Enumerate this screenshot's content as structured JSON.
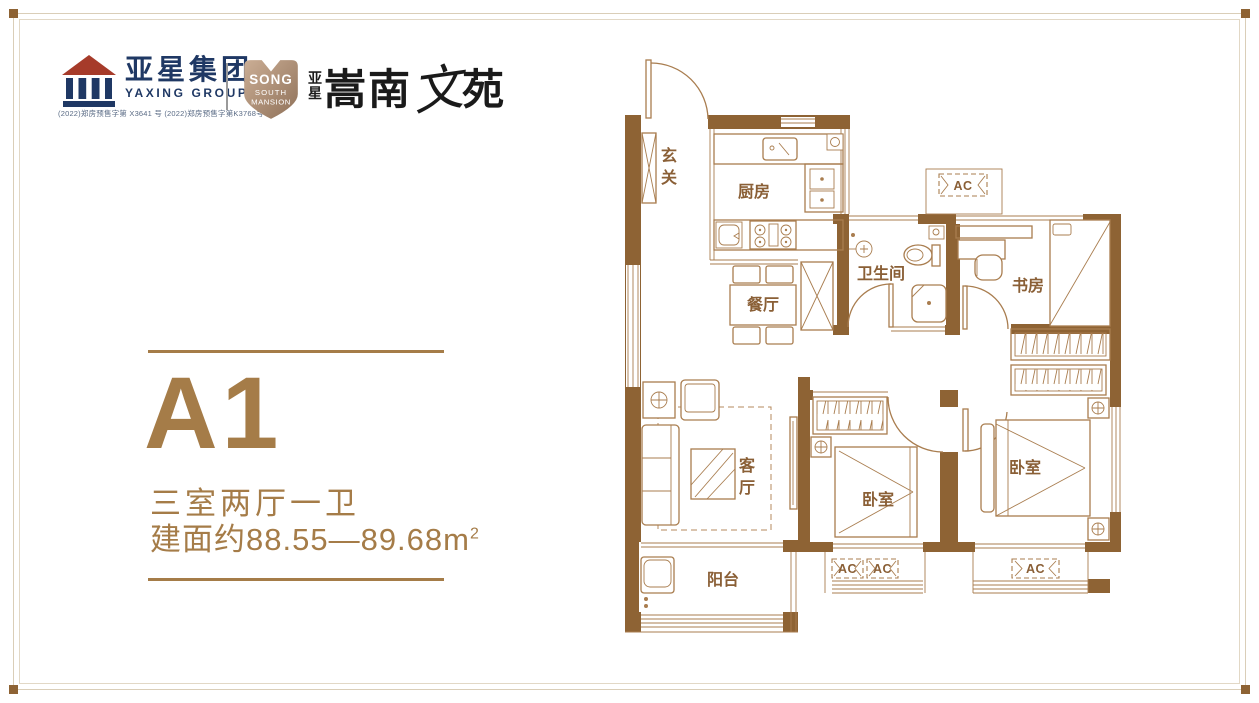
{
  "header": {
    "logo": {
      "name": "亚星集团",
      "reg_mark": "®",
      "sub": "YAXING GROUP",
      "permits": "(2022)郑房预售字第 X3641 号 (2022)郑房预售字第K3768号"
    },
    "badge": {
      "line1": "SONG",
      "line2": "SOUTH",
      "line3": "MANSION"
    },
    "brand": {
      "prefix_top": "亚",
      "prefix_bottom": "星",
      "name_pre": "嵩南",
      "name_stylized": "文",
      "name_post": "苑"
    }
  },
  "info": {
    "unit_code": "A1",
    "layout_desc": "三室两厅一卫",
    "area_prefix": "建面约",
    "area_value": "88.55—89.68",
    "area_unit": "m",
    "area_sup": "2"
  },
  "floorplan": {
    "colors": {
      "wall": "#8E6334",
      "line": "#A97D4F",
      "label": "#8A5F36",
      "accent": "#A57C48"
    },
    "labels": {
      "foyer": [
        "玄",
        "关"
      ],
      "kitchen": "厨房",
      "dining": "餐厅",
      "bath": "卫生间",
      "study": "书房",
      "living": [
        "客",
        "厅"
      ],
      "bed1": "卧室",
      "bed2": "卧室",
      "balcony": "阳台",
      "ac": "AC"
    }
  }
}
